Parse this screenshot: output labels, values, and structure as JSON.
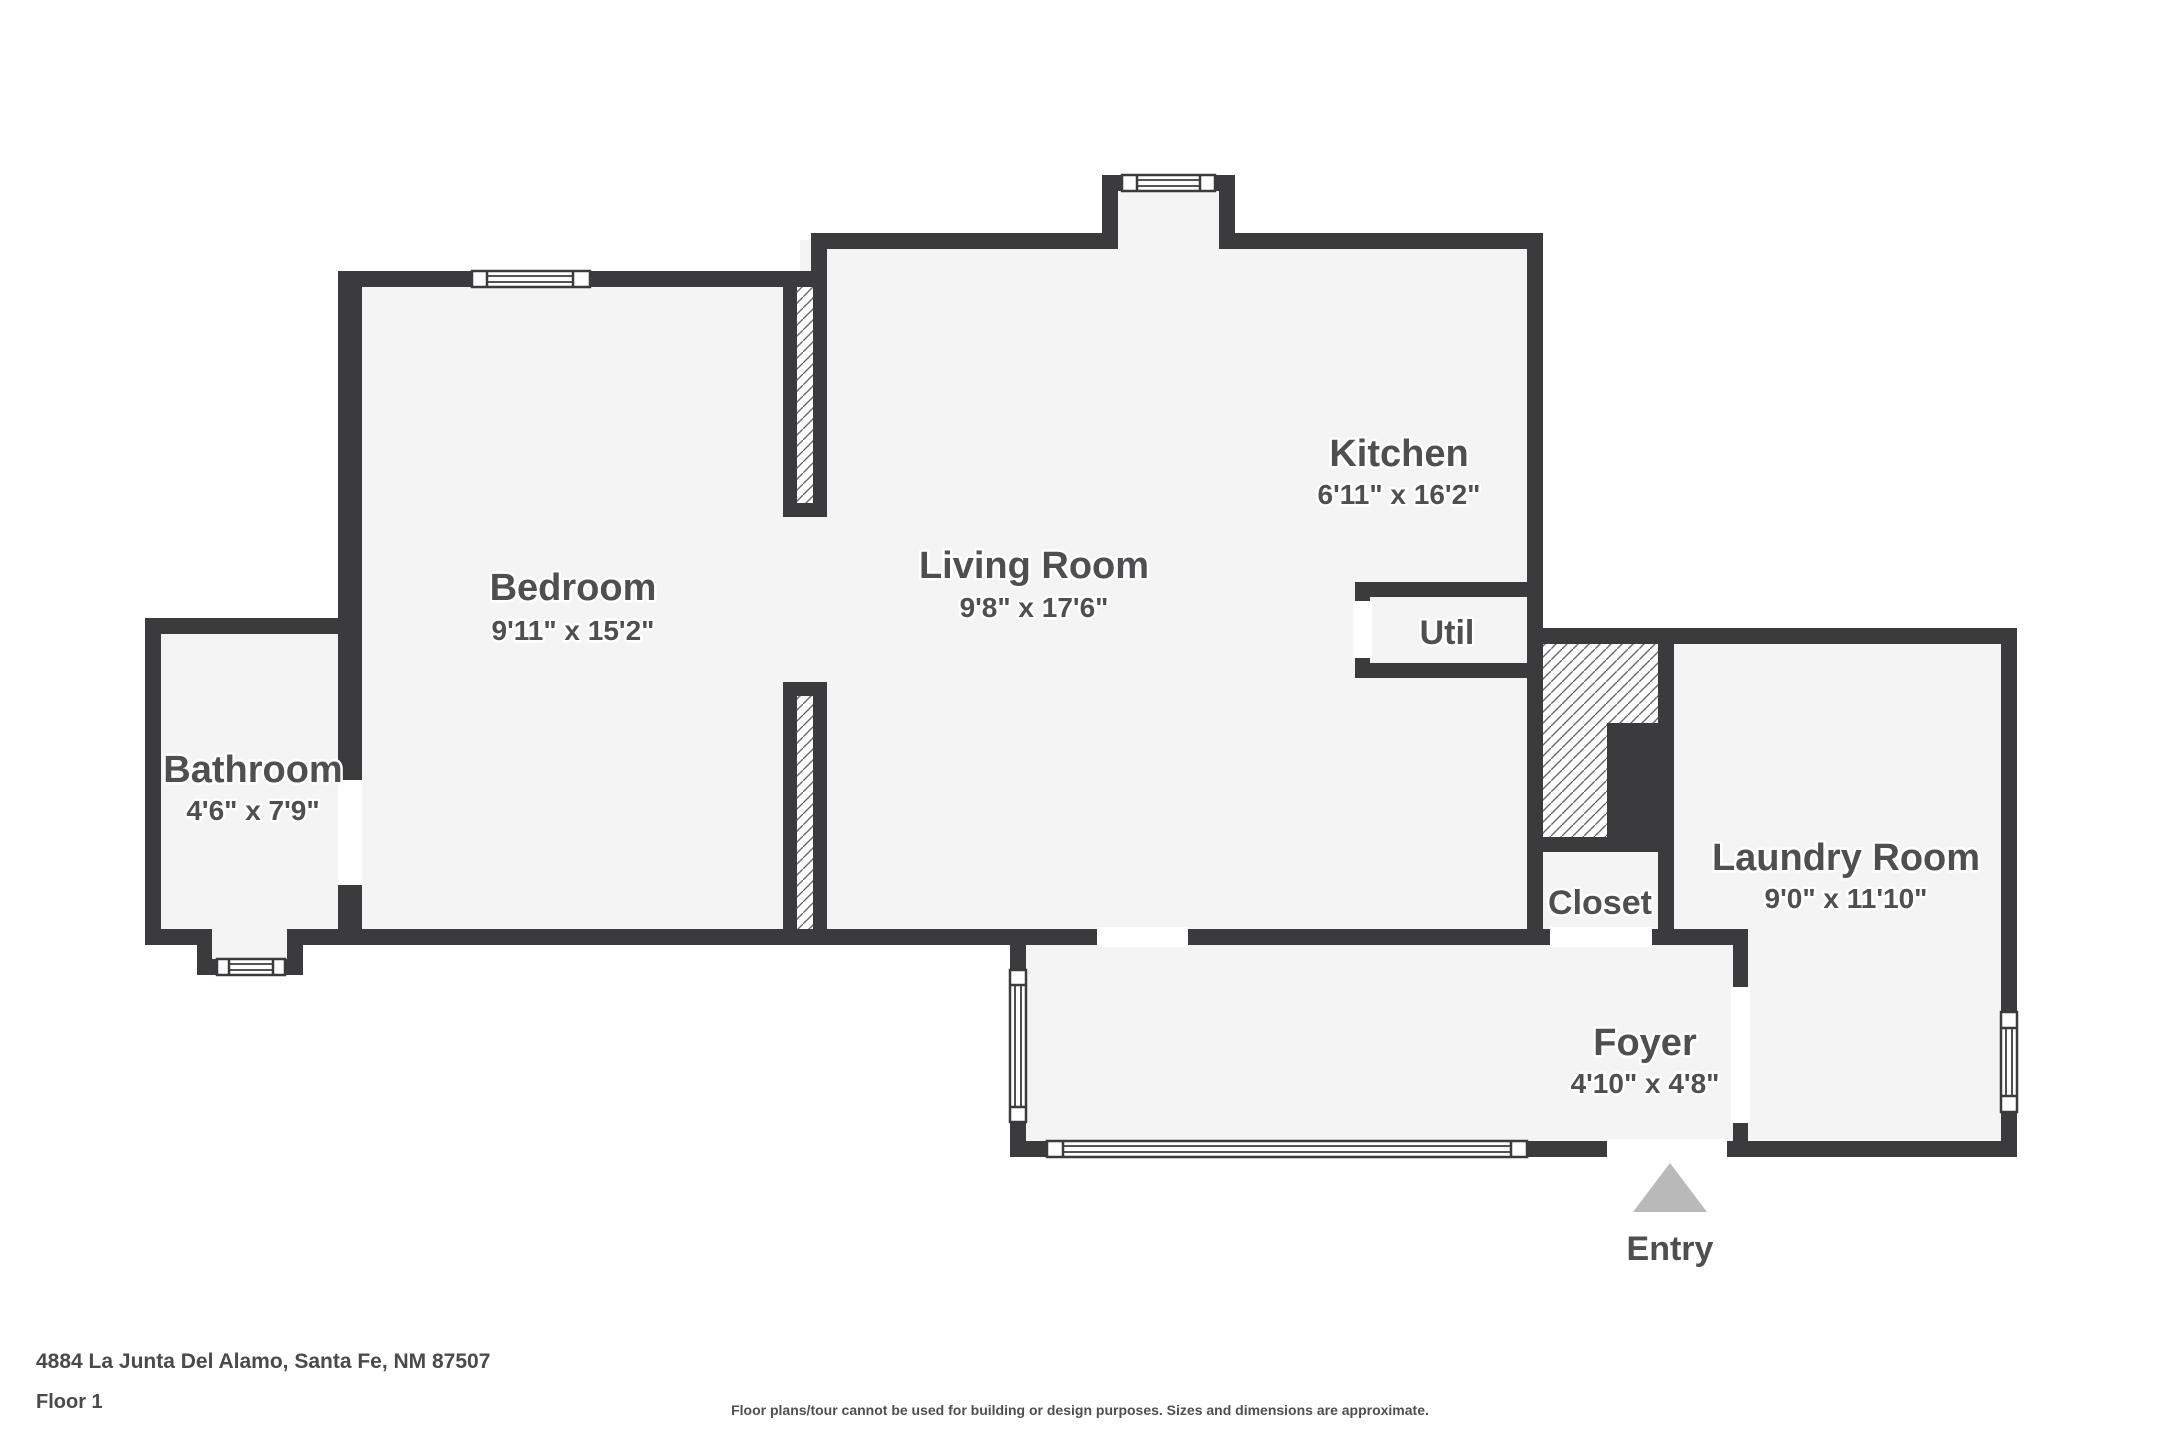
{
  "rooms": {
    "bedroom": {
      "label": "Bedroom",
      "dims": "9'11\" x 15'2\""
    },
    "living": {
      "label": "Living Room",
      "dims": "9'8\" x 17'6\""
    },
    "kitchen": {
      "label": "Kitchen",
      "dims": "6'11\" x 16'2\""
    },
    "util": {
      "label": "Util"
    },
    "bathroom": {
      "label": "Bathroom",
      "dims": "4'6\" x 7'9\""
    },
    "closet": {
      "label": "Closet"
    },
    "laundry": {
      "label": "Laundry Room",
      "dims": "9'0\" x 11'10\""
    },
    "foyer": {
      "label": "Foyer",
      "dims": "4'10\" x 4'8\""
    }
  },
  "entry": {
    "label": "Entry"
  },
  "footer": {
    "address": "4884 La Junta Del Alamo, Santa Fe, NM 87507",
    "floor": "Floor 1",
    "disclaimer": "Floor plans/tour cannot be used for building or design purposes. Sizes and dimensions are approximate."
  },
  "colors": {
    "wall": "#3b3b3d",
    "floor": "#f4f4f5",
    "text": "#4f4f51",
    "arrow": "#b9b9b9",
    "hatch_line": "#6a6a6c"
  }
}
